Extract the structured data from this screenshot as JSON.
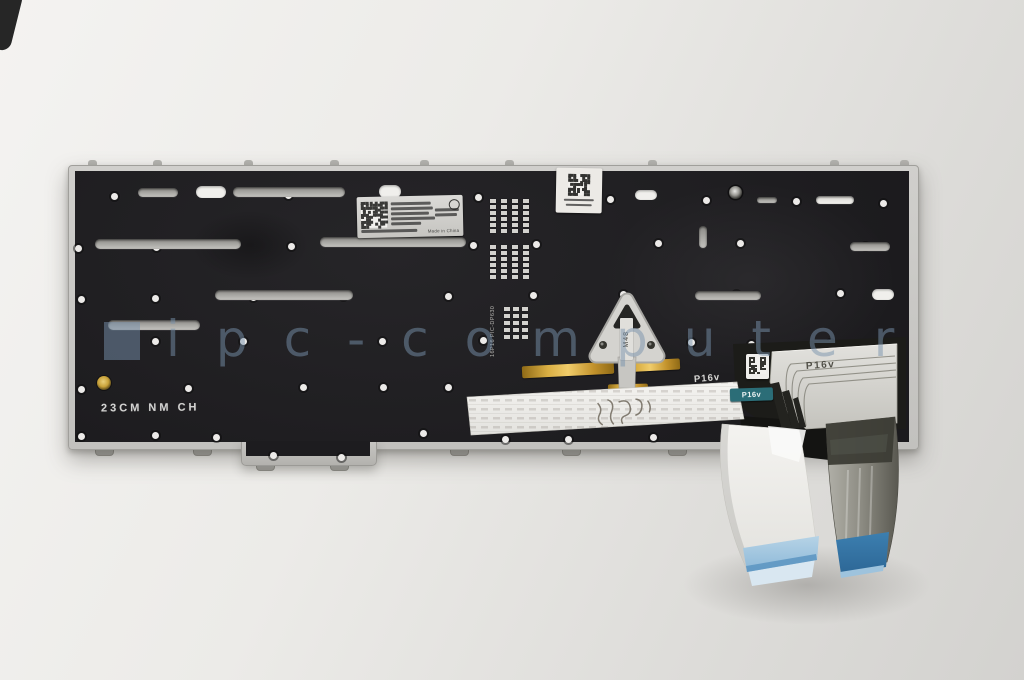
{
  "photo": {
    "alt": "Rear side of a laptop keyboard module with backlight film, metal backplate and two ribbon cables",
    "watermark_text": "ipc-computer",
    "stencil_text": "23CM NM CH"
  },
  "markings": {
    "flex_print": "P16v",
    "white_print": "P16v",
    "teal_sticker": "P16v",
    "triangle_sticker": "M48",
    "vertical_code": "16P16 PIC-DP630",
    "label_origin": "Made in China"
  },
  "colors": {
    "background": "#ecebe8",
    "plate_mylar": "#201f22",
    "plate_rim": "#c7c6c3",
    "gold_strip": "#d2a03a",
    "white_cable_tip": "#8fb8d6",
    "dark_cable_tip": "#2e74a6",
    "teal_label": "#2b6d77",
    "watermark": "#7892ac"
  }
}
